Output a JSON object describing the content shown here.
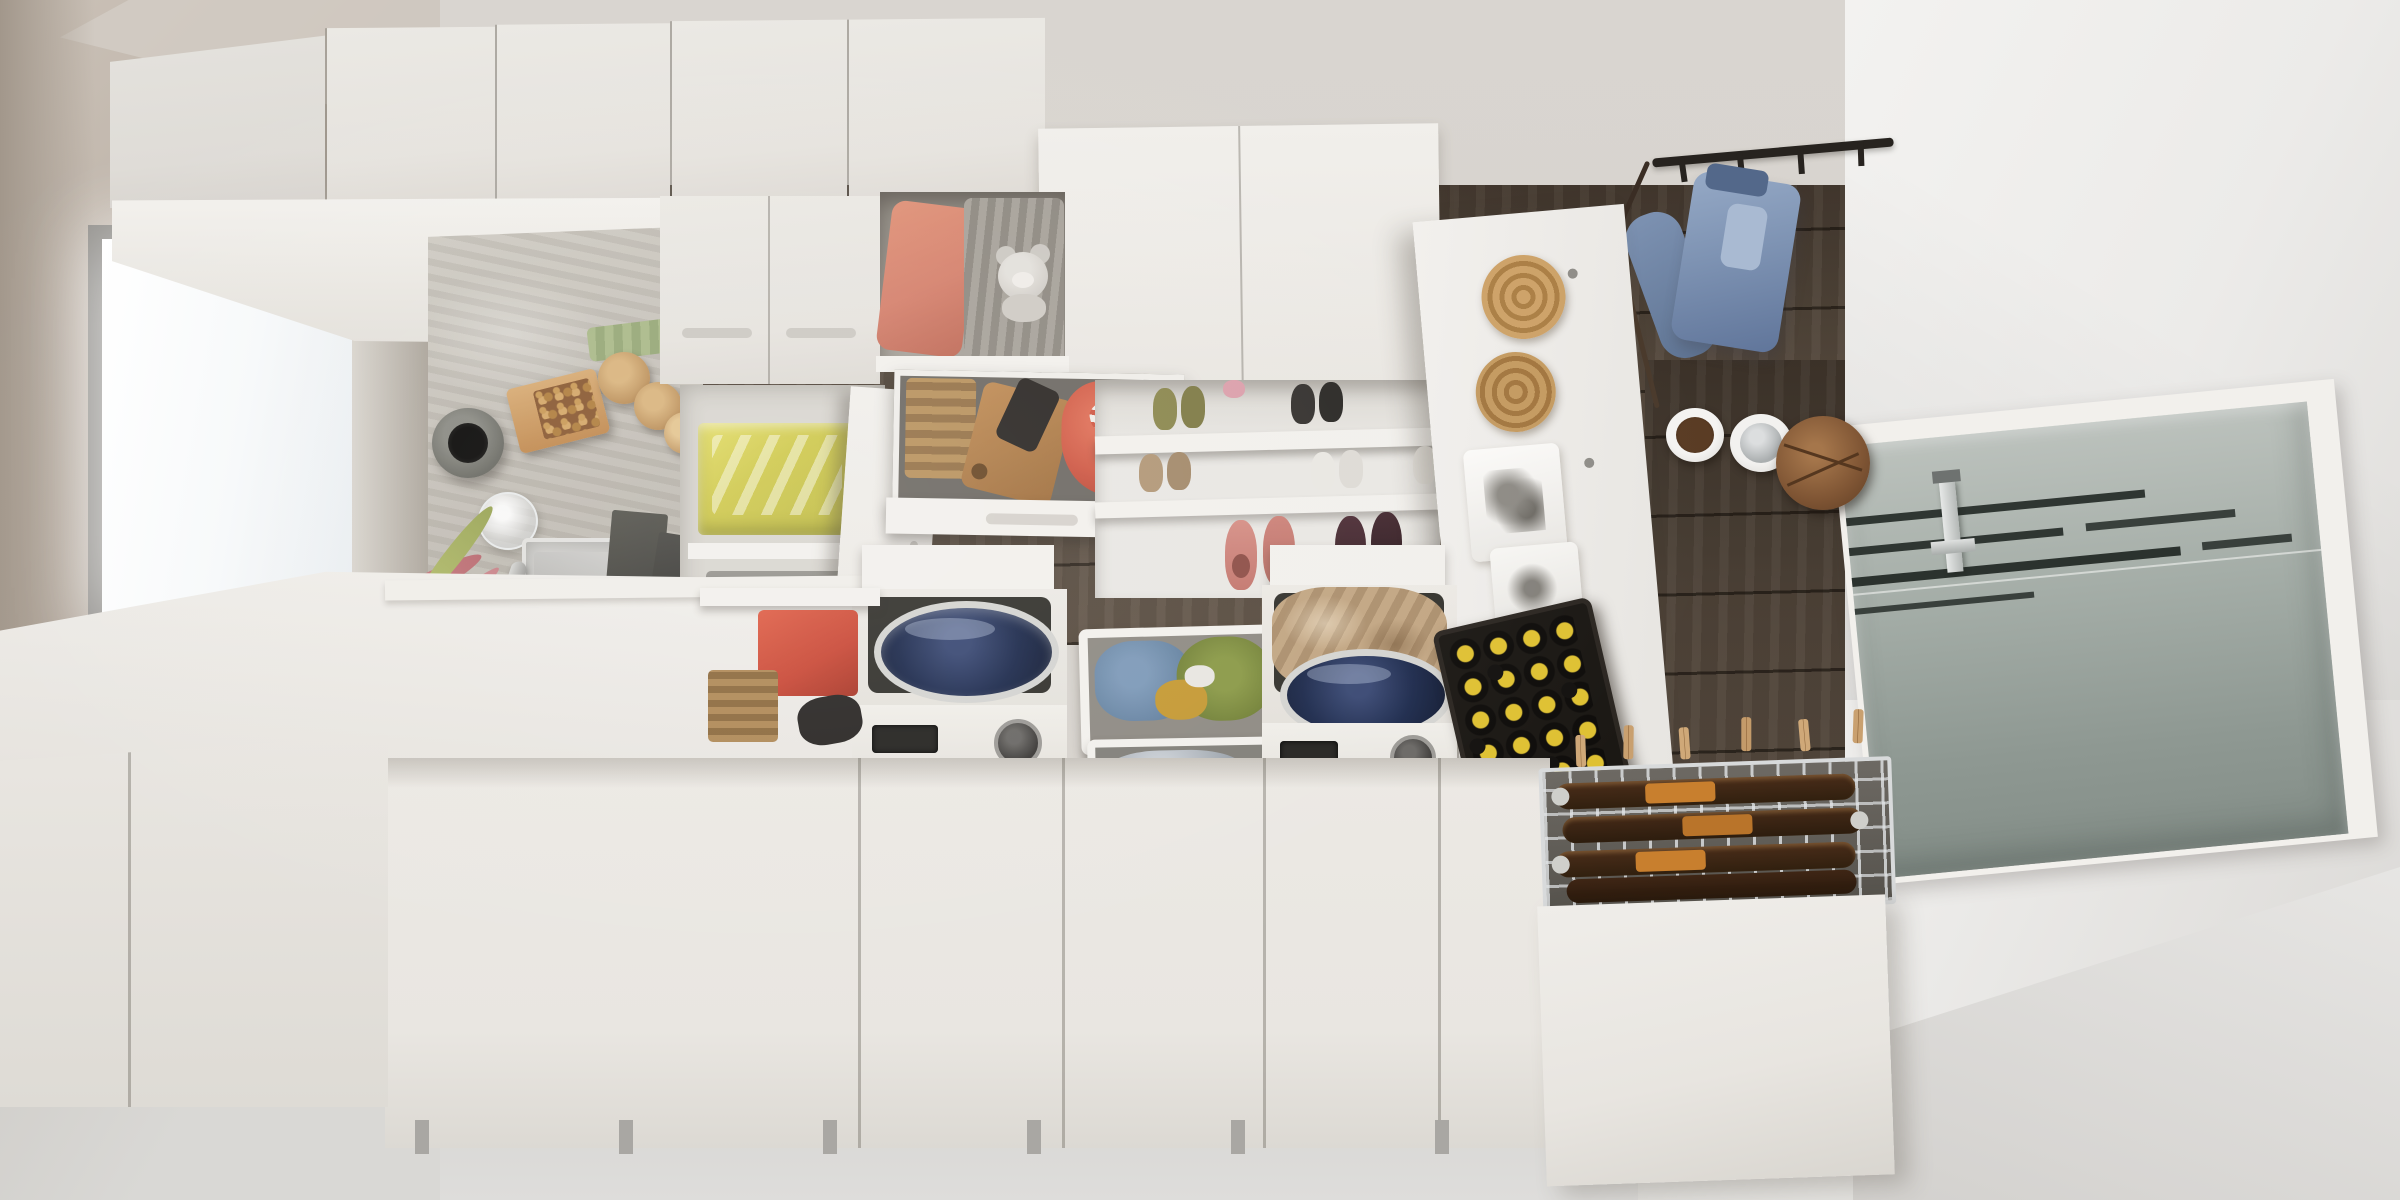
{
  "scene": {
    "title": "Top-down view of a small laundry / utility room",
    "description": "Bird's-eye photograph of a laundry room: white cabinet runs along two walls, a window with a pink hanging plant over a concrete counter with steel sink, an open recycling cabinet, an open wardrobe bench with cushion and teddy bear, pull-out shoe shelves, a pegboard with rattan mats and slippers, two top-loading washing machines with stacked laundry baskets between them, a black beer crate, a pull-out drying rack with bottles and clothespins, dark wood plank flooring in the centre, a coat rail with a denim jacket, dog bowls, and a frosted glass entry door on the right.",
    "view": "top-down"
  },
  "palette": {
    "ceiling": "#d8d4cf",
    "wall_left": "#b9aea3",
    "wall_right": "#f0efed",
    "cabinet_white": "#ebe9e4",
    "wood_dark": "#43382e",
    "wood_mid": "#564a3e",
    "floor_light": "#dbdad7",
    "concrete": "#c6c2ba",
    "steel": "#c3c3c1",
    "navy_drum": "#1f2c4e",
    "coral": "#d5826e",
    "pink_towel": "#e89a92",
    "red_box": "#c94a38",
    "yellow_bag": "#d3cc4f",
    "cap_yellow": "#dfc133",
    "denim": "#7e93b3",
    "beige_towel": "#c2a683",
    "glass_frost": "#9fa8a2",
    "crate_black": "#1b1814",
    "rattan": "#c49a60",
    "wood_item": "#a97c4f"
  },
  "objects": {
    "ceiling": "White ceiling",
    "wall_left": "Warm grey wall on the left",
    "window": "Window with daylight",
    "window_glass": "Bright glazing",
    "counter": "Concrete countertop",
    "sink": "Stainless steel sink",
    "faucet": "Steel faucet",
    "vase": "Dark grey vase seen from above",
    "nut_box": "Open cardboard box with nuts",
    "wooden_jars": "Round wooden jars",
    "glass_pitcher": "Glass pitcher",
    "green_cloth": "Folded green cloth",
    "recycling_cabinet": "Open cabinet with recycling bins",
    "recycling_bag": "Bin with yellow plastic bag",
    "waste_bin": "Grey waste bins",
    "cabinet_door_open": "Open white cabinet door",
    "upper_cabinets": "Run of white wall cabinets",
    "cabinet_underside": "Underside of wall cabinets",
    "closed_cabinets": "Closed cabinet doors with recessed handles",
    "wardrobe_opening": "Open wardrobe bench compartment",
    "cushion": "Coral seat cushion",
    "blanket": "Grey knitted blanket",
    "teddy_bear": "Grey teddy bear",
    "drawer": "Pulled-out drawer",
    "wicker_basket": "Small wicker basket",
    "cutting_board": "Wooden board with shoe brushes",
    "red_textile": "Red folded textile",
    "plant": "Hanging plant with pink foliage",
    "plant_pot": "Dark plant pot",
    "boards": "Dark boards leaning at the bench",
    "tall_panel": "Tall white cabinet panel",
    "shoe_shelf": "Pull-out shoe shelves",
    "shoes_olive": "Olive sneakers",
    "shoes_dark": "Dark sneakers",
    "shoes_tan": "Tan shoes",
    "shoes_white": "White sneakers",
    "shoes_pink": "Pink slip-on shoes",
    "shoes_burgundy": "Burgundy sneakers",
    "pegboard": "White pegboard panel",
    "rattan_mats": "Round rattan mats",
    "paper_bags": "White paper bags",
    "slippers": "Pair of tan slippers",
    "coat_rail": "Black coat rail with hooks",
    "denim_jacket": "Denim jacket on a hook",
    "leash": "Dog leash hanging from the rail",
    "dog_food_bowl": "Dog bowl with food",
    "dog_water_bowl": "Steel dog water bowl",
    "wooden_box": "Round wooden box",
    "wood_floor": "Dark wood plank floor",
    "corridor_floor": "Wood floor corridor by the door",
    "right_wall": "White wall on the right",
    "glass_door": "Frosted glass entry door",
    "door_stripes": "Etched stripes in the glass",
    "door_handle": "Steel door handle",
    "floor_right": "Light grey floor by the door",
    "bench_top": "White bench top under the window",
    "bench_fronts": "White bench fronts",
    "washer1": "Top-loading washing machine (left)",
    "washer1_lid": "Open washer lid",
    "washer1_drum": "Navy blue drum lid",
    "washer1_panel": "Washer control panel",
    "washer1_display": "Washer display",
    "washer1_knob": "Washer program knob",
    "basket_top": "Laundry basket with jeans and green garment",
    "basket_mid": "Laundry basket with grey laundry",
    "basket_front": "Laundry basket with pink waffle towel",
    "pink_towel": "Pink waffle-weave towel",
    "washer2": "Top-loading washing machine (right)",
    "towel_beige": "Beige towel in the washer opening",
    "washer2_drum": "Navy blue drum lid",
    "washer2_panel": "Washer control panel",
    "washer2_display": "Washer display",
    "washer2_knob": "Washer program knob",
    "beer_crate": "Black crate of bottles with yellow caps",
    "drying_rack": "Pull-out wire rack with bottles",
    "beer_bottle": "Brown bottle lying in the rack",
    "clothespin": "Wooden clothespin",
    "rack_cabinet": "Tall white cabinet under the rack",
    "base_fronts": "White base cabinet fronts",
    "cabinet_legs": "Slim cabinet legs",
    "floor_bottom": "Light grey screed floor"
  },
  "beer_crate_grid": {
    "rows": 5,
    "cols": 4,
    "cap_color": "#dfc133",
    "dark_caps": 4
  },
  "door_stripe_count": 4,
  "shoe_pairs_visible": 6
}
